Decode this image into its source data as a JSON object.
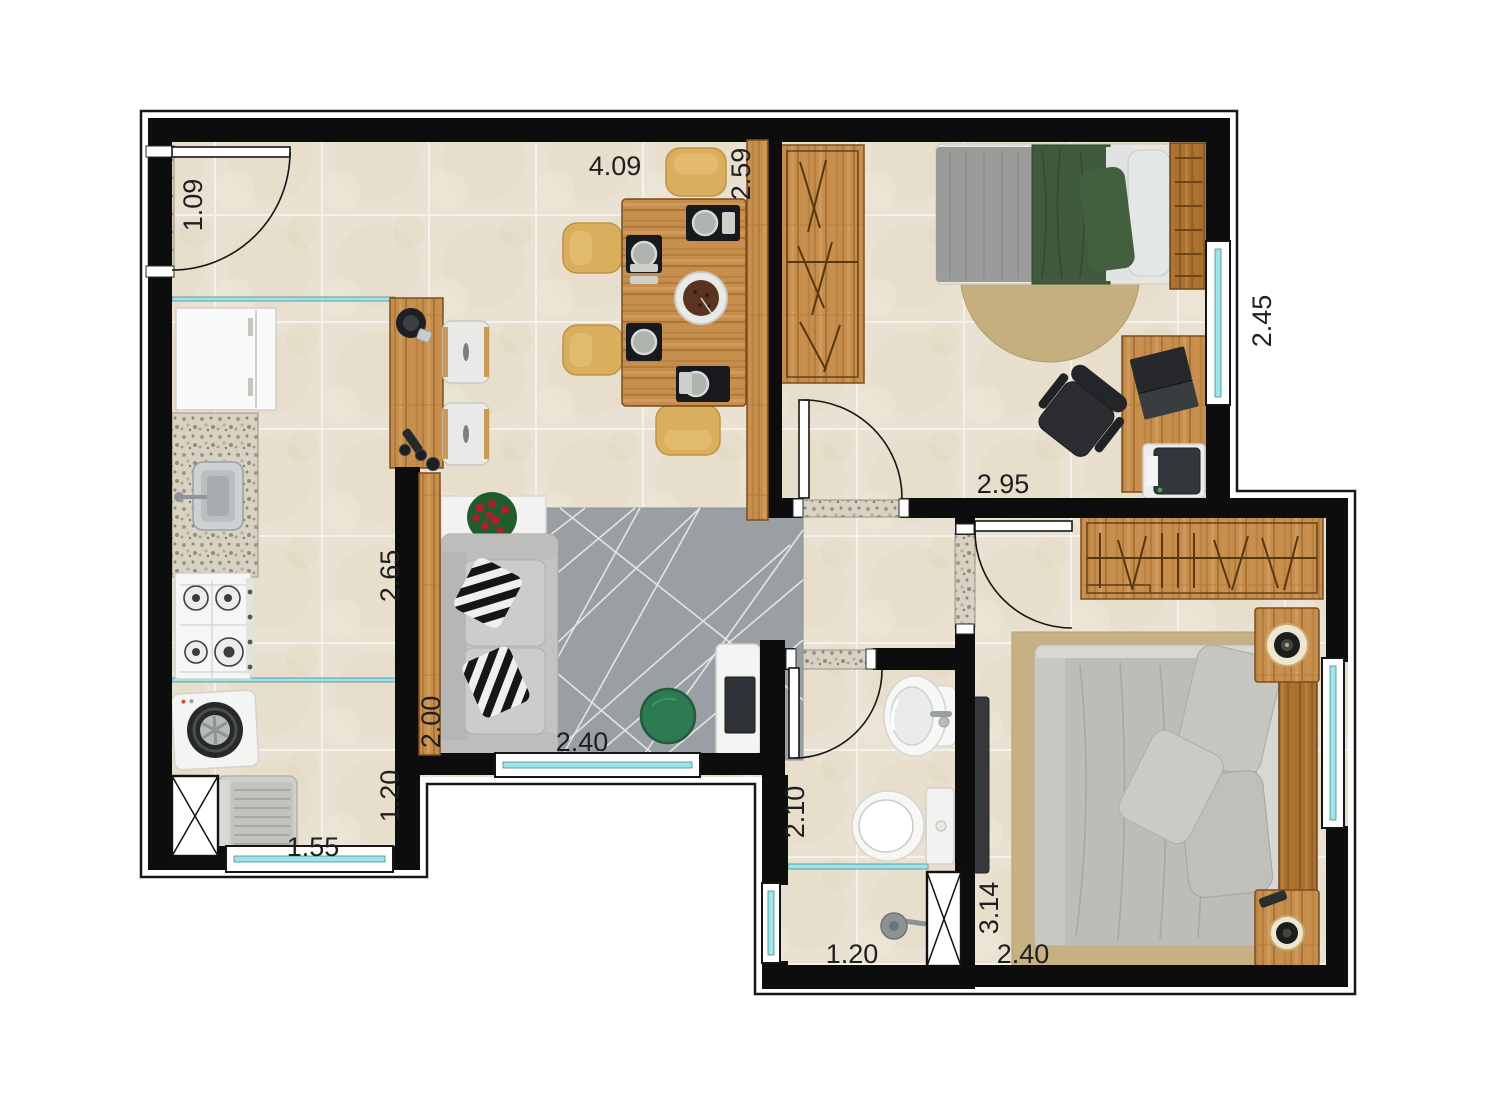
{
  "plan_type": "apartment-floor-plan",
  "dims": [
    {
      "id": "entry-opening",
      "v": "1.09"
    },
    {
      "id": "living-width",
      "v": "4.09"
    },
    {
      "id": "dining-depth",
      "v": "2.59"
    },
    {
      "id": "bedroom1-width",
      "v": "2.95"
    },
    {
      "id": "bedroom1-depth",
      "v": "2.45"
    },
    {
      "id": "kitchen-depth",
      "v": "2.65"
    },
    {
      "id": "living-side",
      "v": "2.00"
    },
    {
      "id": "laundry-depth",
      "v": "1.20"
    },
    {
      "id": "laundry-width",
      "v": "1.55"
    },
    {
      "id": "living-window-width",
      "v": "2.40"
    },
    {
      "id": "bathroom-depth",
      "v": "2.10"
    },
    {
      "id": "bathroom-width",
      "v": "1.20"
    },
    {
      "id": "master-depth",
      "v": "3.14"
    },
    {
      "id": "master-width",
      "v": "2.40"
    }
  ],
  "palette": {
    "wall": "#0d0d0d",
    "floor_tile": "#e9e1d1",
    "window_glass": "#9fe4e8",
    "wood": "#c68e4e",
    "granite": "#d8d2c5",
    "living_rug": "#999fa3",
    "bedroom_rug": "#c6b184",
    "pouf_green": "#2c7a50",
    "duvet_green": "#3f5a3c",
    "dining_chair": "#d9ae5c",
    "fixture_white": "#f6f6f4"
  }
}
